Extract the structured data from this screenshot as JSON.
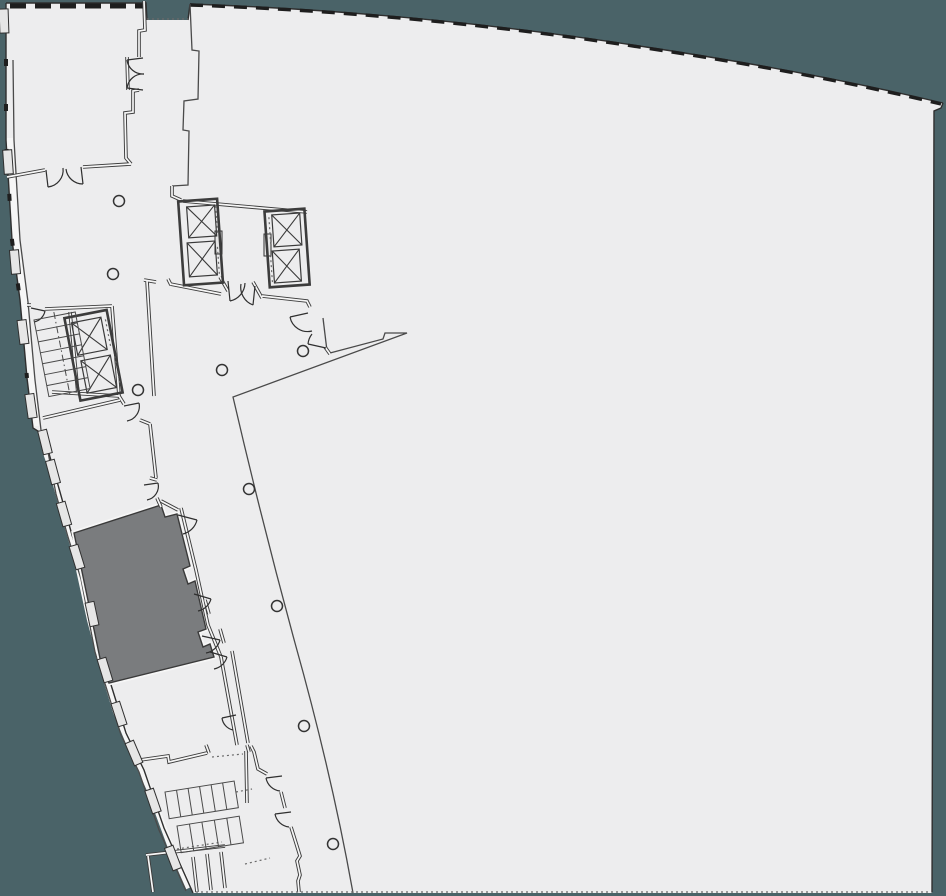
{
  "meta": {
    "app": "architectural-floor-plan-viewer",
    "floor_text": "",
    "notes": "floor plan with one highlighted (selected) room, two elevator banks, stairwells, columns and a large open tenant area"
  },
  "colors": {
    "outside": "#4a6368",
    "floor": "#ededee",
    "wall": "#3c3c3c",
    "cavity": "#f6f6f6",
    "line": "#4a4a4a",
    "dotted": "#6a6a6a",
    "glaze": "#1e1e1e",
    "highlight_room_fill": "#7a7c7e",
    "highlight_room_edge": "#3a3a3a"
  },
  "highlighted_room": {
    "state": "selected",
    "fill": "#7a7c7e"
  },
  "columns": {
    "radius": 5.5,
    "points": [
      [
        119,
        201
      ],
      [
        113,
        274
      ],
      [
        138,
        390
      ],
      [
        222,
        370
      ],
      [
        303,
        351
      ],
      [
        249,
        489
      ],
      [
        277,
        606
      ],
      [
        304,
        726
      ],
      [
        333,
        844
      ]
    ]
  },
  "elevator_banks": [
    {
      "id": "upper-left-bank",
      "angle": -4,
      "cx": 201,
      "cy": 241,
      "outer": [
        181,
        200,
        39,
        84
      ],
      "shafts": [
        [
          189,
          206,
          28,
          31
        ],
        [
          187,
          242,
          28,
          34
        ]
      ],
      "door_dots": [
        [
          218,
          207,
          218,
          236
        ],
        [
          217,
          248,
          217,
          276
        ]
      ]
    },
    {
      "id": "upper-right-bank",
      "angle": -4,
      "cx": 287,
      "cy": 247,
      "outer": [
        267,
        210,
        40,
        76
      ],
      "shafts": [
        [
          274,
          214,
          28,
          32
        ],
        [
          272,
          250,
          27,
          32
        ]
      ],
      "door_dots": [
        [
          271,
          216,
          271,
          243
        ],
        [
          270,
          254,
          270,
          281
        ]
      ]
    },
    {
      "id": "lower-left-bank",
      "angle": -11,
      "cx": 95,
      "cy": 355,
      "outer": [
        72,
        313,
        43,
        84
      ],
      "shafts": [
        [
          78,
          319,
          30,
          33
        ],
        [
          80,
          358,
          30,
          33
        ]
      ],
      "door_dots": [
        [
          112,
          322,
          112,
          349
        ],
        [
          114,
          360,
          114,
          388
        ]
      ]
    }
  ],
  "stairs": [
    {
      "id": "core-stair",
      "x": 34,
      "y": 320,
      "angle": -11,
      "len": 42,
      "depth": 78,
      "treads": 7,
      "dir": "down",
      "center_dash": true
    },
    {
      "id": "block-stair-1",
      "x": 165,
      "y": 792,
      "angle": -9,
      "len": 70,
      "depth": 27,
      "treads": 6,
      "dir": "right",
      "center_dash": false
    },
    {
      "id": "block-stair-2",
      "x": 177,
      "y": 826,
      "angle": -9,
      "len": 63,
      "depth": 27,
      "treads": 5,
      "dir": "right",
      "center_dash": false
    }
  ],
  "facade_panels": [
    {
      "x": 4,
      "y": 21,
      "a": -2
    },
    {
      "x": 8,
      "y": 162,
      "a": -4
    },
    {
      "x": 15,
      "y": 262,
      "a": -5
    },
    {
      "x": 23,
      "y": 332,
      "a": -7
    },
    {
      "x": 31,
      "y": 406,
      "a": -8
    },
    {
      "x": 45,
      "y": 442,
      "a": -14
    },
    {
      "x": 53,
      "y": 472,
      "a": -15
    },
    {
      "x": 64,
      "y": 514,
      "a": -16
    },
    {
      "x": 77,
      "y": 557,
      "a": -17
    },
    {
      "x": 92,
      "y": 614,
      "a": -12
    },
    {
      "x": 105,
      "y": 670,
      "a": -17
    },
    {
      "x": 119,
      "y": 714,
      "a": -18
    },
    {
      "x": 134,
      "y": 753,
      "a": -23
    },
    {
      "x": 153,
      "y": 801,
      "a": -19
    },
    {
      "x": 173,
      "y": 858,
      "a": -21
    }
  ]
}
